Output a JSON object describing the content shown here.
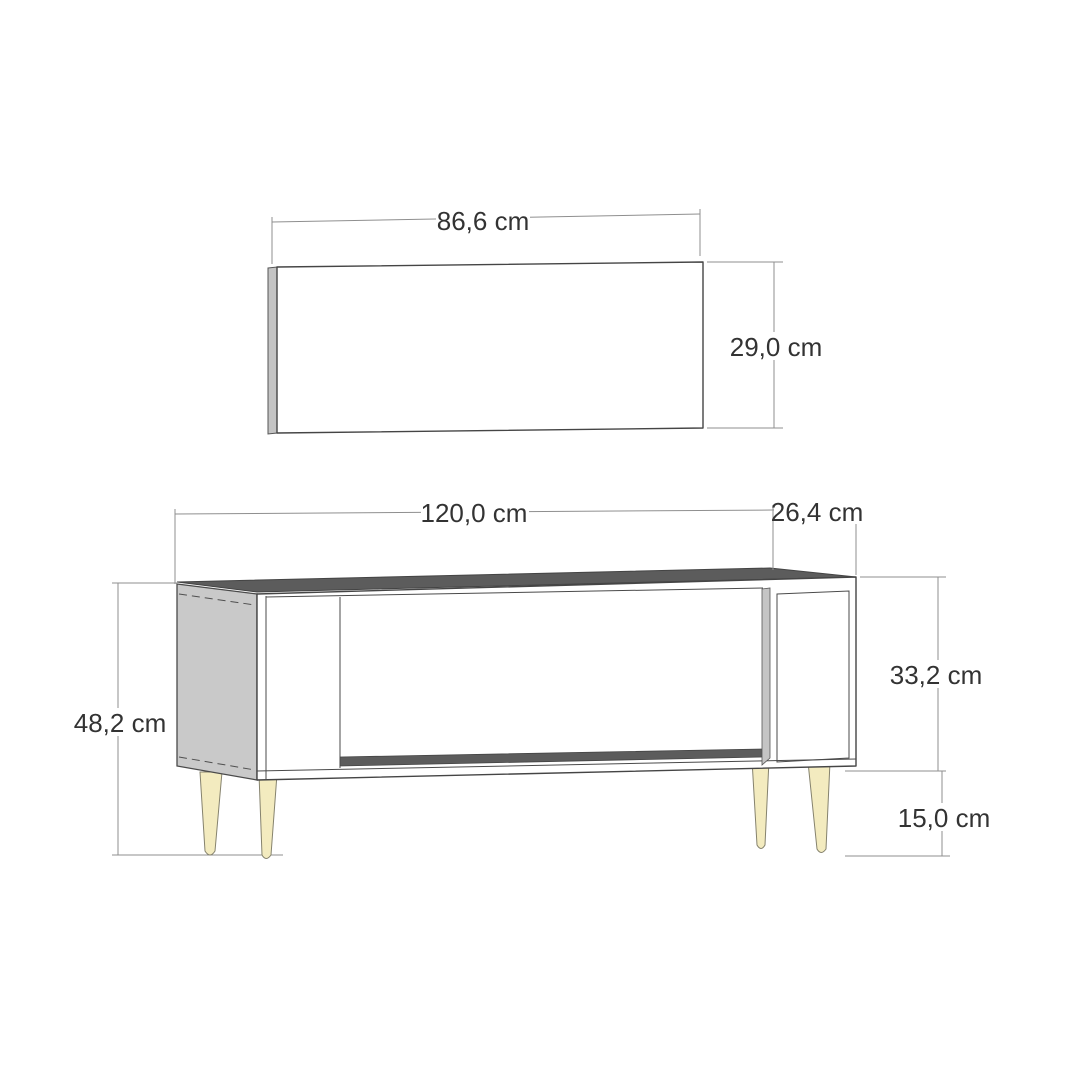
{
  "diagram": {
    "wall_panel": {
      "width_label": "86,6 cm",
      "height_label": "29,0 cm"
    },
    "tv_stand": {
      "width_label": "120,0 cm",
      "depth_label": "26,4 cm",
      "carcass_height_label": "33,2 cm",
      "leg_height_label": "15,0 cm",
      "total_height_label": "48,2 cm"
    },
    "colors": {
      "background": "#ffffff",
      "outline": "#454545",
      "dimension_line": "#8f8f8f",
      "label_text": "#333333",
      "side_panel_gray": "#c9c9c9",
      "edge_strip_gray": "#c4c4c4",
      "divider_strip_gray": "#c4c4c4",
      "top_surface_dark": "#5c5c5c",
      "bottom_shelf_dark": "#5c5c5c",
      "leg_cream": "#f3ebbf"
    }
  }
}
